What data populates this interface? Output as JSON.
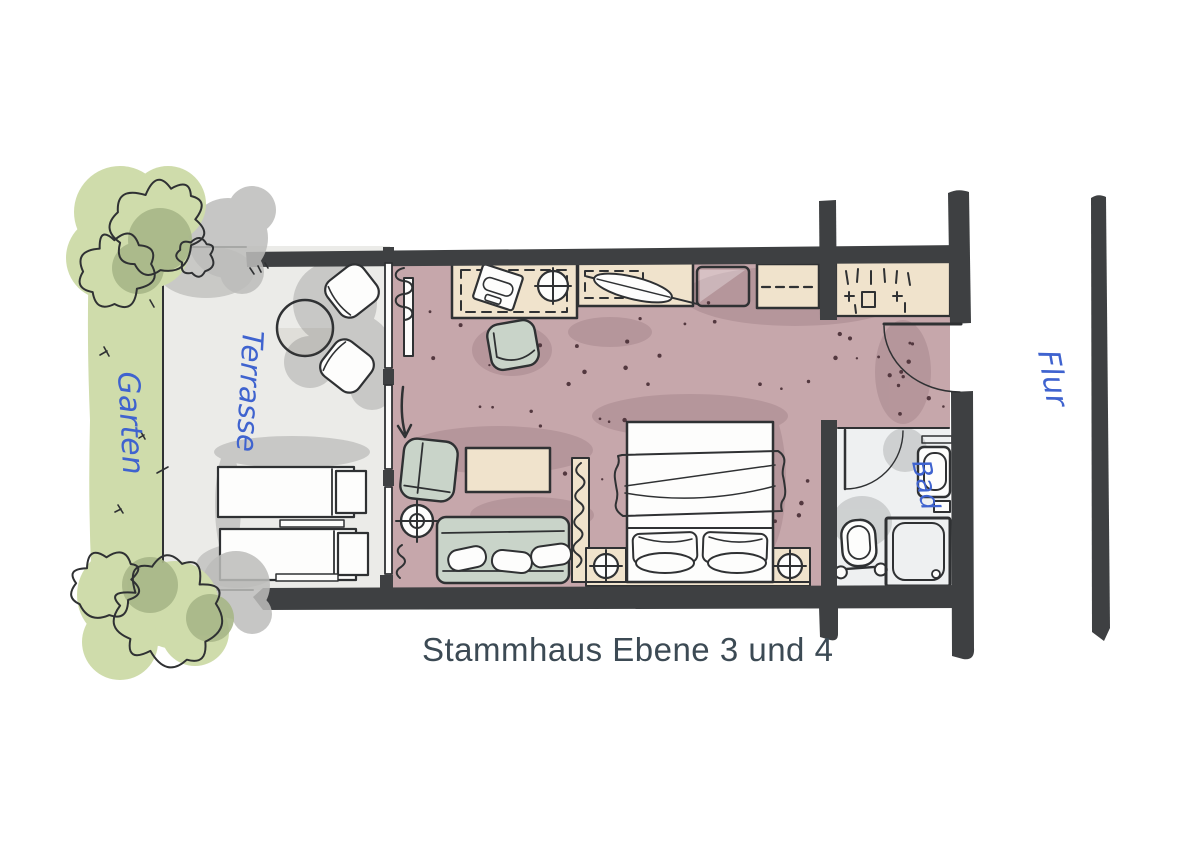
{
  "title": "Stammhaus Ebene 3 und 4",
  "labels": {
    "garden": "Garten",
    "terrace": "Terrasse",
    "bathroom": "Bad",
    "corridor": "Flur"
  },
  "colors": {
    "wall": "#3e4042",
    "room_floor": "#c6a7ab",
    "terrace_floor": "#ebebe8",
    "bath_floor": "#eef0f1",
    "garden_green": "#cfdcab",
    "bush_light": "#dfe9c5",
    "bush_mid": "#cdd9a8",
    "bush_dark": "#a8b788",
    "furniture_beige": "#f0e3cc",
    "furniture_sage": "#c9d4c9",
    "label_blue": "#3f63cf",
    "title_color": "#3c4a54",
    "sketch_line": "#2f3133",
    "shadow_gray": "#bdbdbb",
    "shadow_mauve": "#8d6b74",
    "speckle": "#53383f"
  }
}
